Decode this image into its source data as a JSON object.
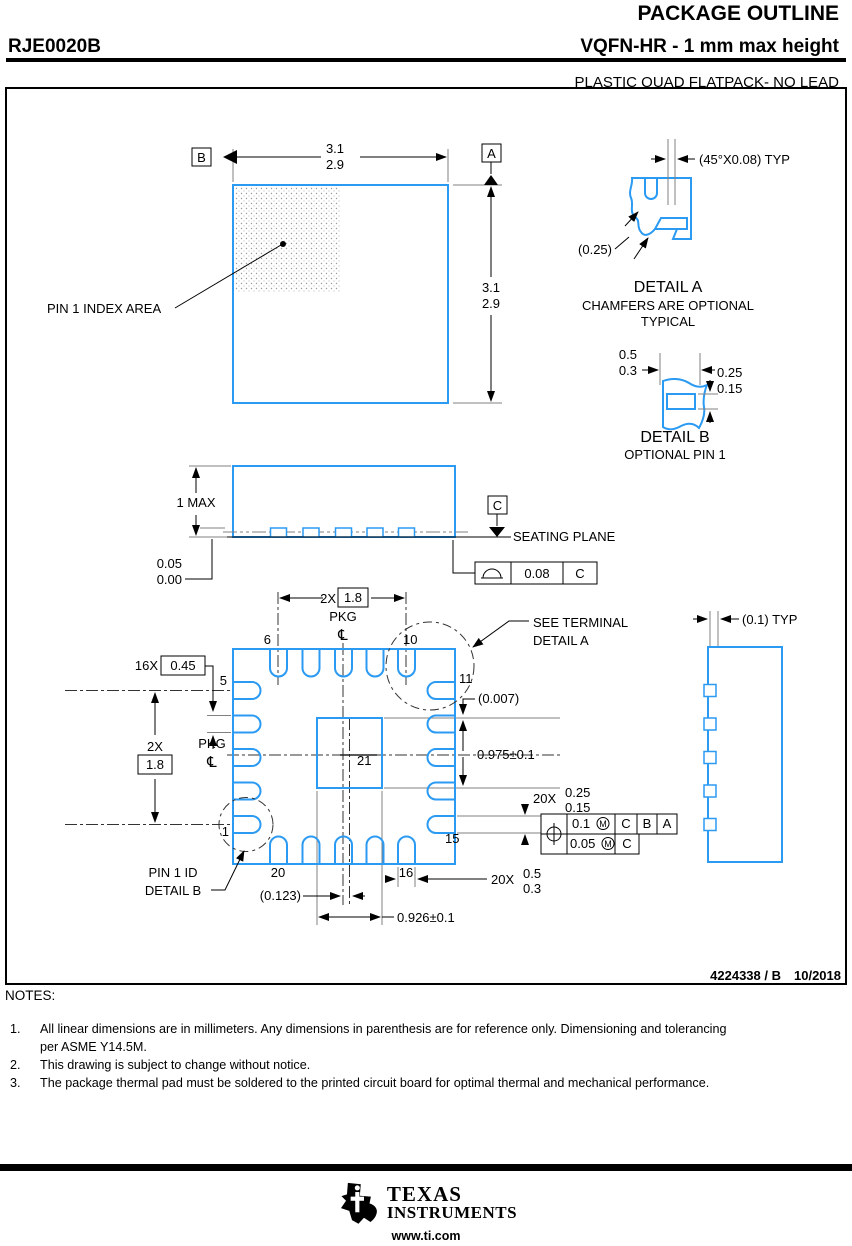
{
  "header": {
    "title": "PACKAGE OUTLINE",
    "part_number": "RJE0020B",
    "package_type": "VQFN-HR - 1 mm max height",
    "subtitle": "PLASTIC QUAD FLATPACK- NO LEAD"
  },
  "d": {
    "tv": {
      "b": "B",
      "a": "A",
      "w1": "3.1",
      "w2": "2.9",
      "h1": "3.1",
      "h2": "2.9",
      "pin1": "PIN 1 INDEX AREA"
    },
    "da": {
      "dim": "(45°X0.08) TYP",
      "ref": "(0.25)",
      "t": "DETAIL A",
      "n1": "CHAMFERS ARE OPTIONAL",
      "n2": "TYPICAL"
    },
    "db": {
      "w1": "0.5",
      "w2": "0.3",
      "h1": "0.25",
      "h2": "0.15",
      "t": "DETAIL B",
      "n": "OPTIONAL PIN 1"
    },
    "sv": {
      "h": "1 MAX",
      "s1": "0.05",
      "s2": "0.00",
      "c": "C",
      "seat": "SEATING PLANE",
      "f": "0.08",
      "fd": "C"
    },
    "bv": {
      "p2x": "2X",
      "p18": "1.8",
      "pkg": "PKG",
      "cl": "℄",
      "lw16": "16X",
      "lw": "0.45",
      "n1": "1",
      "n5": "5",
      "n6": "6",
      "n10": "10",
      "n11": "11",
      "n15": "15",
      "n16": "16",
      "n20": "20",
      "n21": "21",
      "st1": "SEE TERMINAL",
      "st2": "DETAIL A",
      "r007": "(0.007)",
      "padl": "0.975±0.1",
      "m20": "20X",
      "lr1": "0.25",
      "lr2": "0.15",
      "lb1": "0.5",
      "lb2": "0.3",
      "p1id1": "PIN 1 ID",
      "p1id2": "DETAIL B",
      "r123": "(0.123)",
      "padw": "0.926±0.1",
      "fcf": {
        "v1": "0.1",
        "m": "M",
        "c": "C",
        "b": "B",
        "a": "A",
        "v2": "0.05"
      }
    },
    "rv": {
      "dim": "(0.1) TYP"
    },
    "doc1": "4224338 / B",
    "doc2": "10/2018"
  },
  "notes": {
    "label": "NOTES:",
    "items": [
      {
        "num": "1.",
        "line1": "All linear dimensions are in millimeters. Any dimensions in parenthesis are for reference only. Dimensioning and tolerancing",
        "line2": "per ASME Y14.5M."
      },
      {
        "num": "2.",
        "line1": "This drawing is subject to change without notice.",
        "line2": ""
      },
      {
        "num": "3.",
        "line1": "The package thermal pad must be soldered to the printed circuit board for optimal thermal and mechanical performance.",
        "line2": ""
      }
    ]
  },
  "footer": {
    "brand1": "TEXAS",
    "brand2": "INSTRUMENTS",
    "url": "www.ti.com"
  }
}
